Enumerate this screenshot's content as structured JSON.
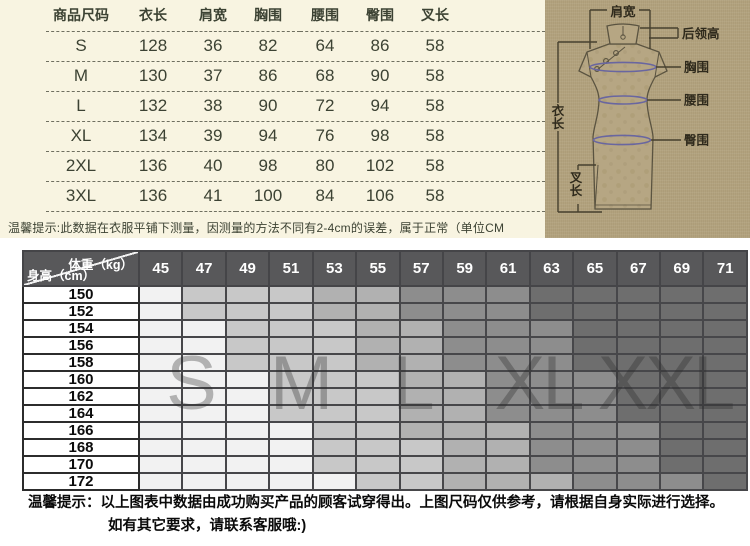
{
  "size_table": {
    "headers": [
      "商品尺码",
      "衣长",
      "肩宽",
      "胸围",
      "腰围",
      "臀围",
      "叉长"
    ],
    "rows": [
      [
        "S",
        "128",
        "36",
        "82",
        "64",
        "86",
        "58"
      ],
      [
        "M",
        "130",
        "37",
        "86",
        "68",
        "90",
        "58"
      ],
      [
        "L",
        "132",
        "38",
        "90",
        "72",
        "94",
        "58"
      ],
      [
        "XL",
        "134",
        "39",
        "94",
        "76",
        "98",
        "58"
      ],
      [
        "2XL",
        "136",
        "40",
        "98",
        "80",
        "102",
        "58"
      ],
      [
        "3XL",
        "136",
        "41",
        "100",
        "84",
        "106",
        "58"
      ]
    ],
    "note": "温馨提示:此数据在衣服平铺下测量，因测量的方法不同有2-4cm的误差，属于正常（单位CM",
    "bg": "#f8f4e1",
    "text_color": "#3c4233"
  },
  "diagram": {
    "bg": "#b2a27e",
    "labels": {
      "shoulder": "肩宽",
      "collar": "后领高",
      "bust": "胸围",
      "waist": "腰围",
      "hip": "臀围",
      "length": "衣长",
      "slit": "叉长"
    },
    "ellipse_color": "#6966a0",
    "line_color": "#46402e"
  },
  "size_matrix": {
    "corner": {
      "top": "体重（kg）",
      "bottom": "身高（cm）"
    },
    "weights": [
      "45",
      "47",
      "49",
      "51",
      "53",
      "55",
      "57",
      "59",
      "61",
      "63",
      "65",
      "67",
      "69",
      "71"
    ],
    "rows": [
      {
        "height": "150",
        "bands": [
          1,
          4,
          6,
          9
        ]
      },
      {
        "height": "152",
        "bands": [
          1,
          4,
          6,
          9
        ]
      },
      {
        "height": "154",
        "bands": [
          2,
          5,
          7,
          10
        ]
      },
      {
        "height": "156",
        "bands": [
          2,
          5,
          7,
          10
        ]
      },
      {
        "height": "158",
        "bands": [
          2,
          5,
          7,
          10
        ]
      },
      {
        "height": "160",
        "bands": [
          3,
          6,
          8,
          11
        ]
      },
      {
        "height": "162",
        "bands": [
          3,
          6,
          8,
          11
        ]
      },
      {
        "height": "164",
        "bands": [
          3,
          6,
          8,
          11
        ]
      },
      {
        "height": "166",
        "bands": [
          4,
          6,
          9,
          12
        ]
      },
      {
        "height": "168",
        "bands": [
          4,
          7,
          9,
          12
        ]
      },
      {
        "height": "170",
        "bands": [
          4,
          7,
          9,
          12
        ]
      },
      {
        "height": "172",
        "bands": [
          5,
          7,
          10,
          13
        ]
      }
    ],
    "zone_order": [
      "S",
      "M",
      "L",
      "XL",
      "XXL"
    ],
    "zone_colors": {
      "S": "#f2f2f2",
      "M": "#c8c8c8",
      "L": "#b1b1b1",
      "XL": "#8d8d8d",
      "XXL": "#6e6e6e"
    },
    "header_bg": "#58585a",
    "overlay_letters": [
      {
        "label": "S",
        "x": 168
      },
      {
        "label": "M",
        "x": 278
      },
      {
        "label": "L",
        "x": 390
      },
      {
        "label": "XL",
        "x": 516
      },
      {
        "label": "XXL",
        "x": 643
      }
    ]
  },
  "footer": {
    "line1": "温馨提示：以上图表中数据由成功购买产品的顾客试穿得出。上图尺码仅供参考，请根据自身实际进行选择。",
    "line2": "如有其它要求，请联系客服哦:)"
  }
}
